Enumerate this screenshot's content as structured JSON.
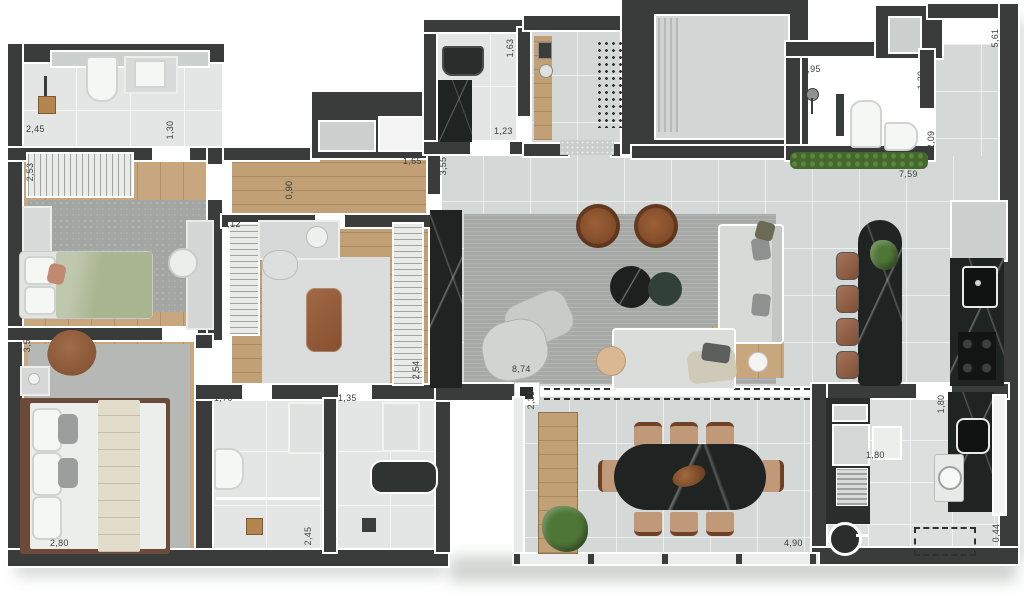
{
  "scene": {
    "kind": "apartment-floor-plan",
    "units_note": "dimension labels in meters with comma decimal"
  },
  "palette": {
    "wall_dark": "#393c3b",
    "wall_outline": "#ffffff",
    "tile_floor": "#d4d8d6",
    "bath_floor": "#e3e6e4",
    "wood_floor": "#c8a77e",
    "living_rug": "#a7a9a6",
    "dark_stone": "#1f2322",
    "leather_brown": "#8f5b3c",
    "bed_green": "#a9b591",
    "plant_green": "#4e7636",
    "sofa_gray": "#d8dad7"
  },
  "dims": [
    {
      "name": "bath1-width",
      "v": "2,45"
    },
    {
      "name": "bath1-door",
      "v": "1,30"
    },
    {
      "name": "bedroom1-wardrobe",
      "v": "2,53"
    },
    {
      "name": "closet-width",
      "v": "3,12"
    },
    {
      "name": "hall-width",
      "v": "0,90"
    },
    {
      "name": "hall-length",
      "v": "1,65"
    },
    {
      "name": "entry-depth",
      "v": "3,55"
    },
    {
      "name": "lavabo-depth",
      "v": "1,63"
    },
    {
      "name": "lavabo-width",
      "v": "1,23"
    },
    {
      "name": "bath4-shower",
      "v": "1,95"
    },
    {
      "name": "bath4-width",
      "v": "1,20"
    },
    {
      "name": "corridor-right-width",
      "v": "2,09"
    },
    {
      "name": "top-wall-length",
      "v": "7,59"
    },
    {
      "name": "corridor-right-length",
      "v": "5,61"
    },
    {
      "name": "master-depth",
      "v": "3,50"
    },
    {
      "name": "master-width",
      "v": "2,80"
    },
    {
      "name": "closet-depth",
      "v": "2,54"
    },
    {
      "name": "living-width",
      "v": "8,74"
    },
    {
      "name": "balcony-depth",
      "v": "2,33"
    },
    {
      "name": "bath2-width",
      "v": "1,70"
    },
    {
      "name": "bath3-width",
      "v": "1,35"
    },
    {
      "name": "bath2-depth",
      "v": "2,45"
    },
    {
      "name": "bath3-depth",
      "v": "2,45"
    },
    {
      "name": "balcony-width",
      "v": "4,90"
    },
    {
      "name": "kitchen-passage",
      "v": "1,80"
    },
    {
      "name": "laundry-width",
      "v": "1,80"
    },
    {
      "name": "laundry-niche",
      "v": "0,44"
    }
  ]
}
